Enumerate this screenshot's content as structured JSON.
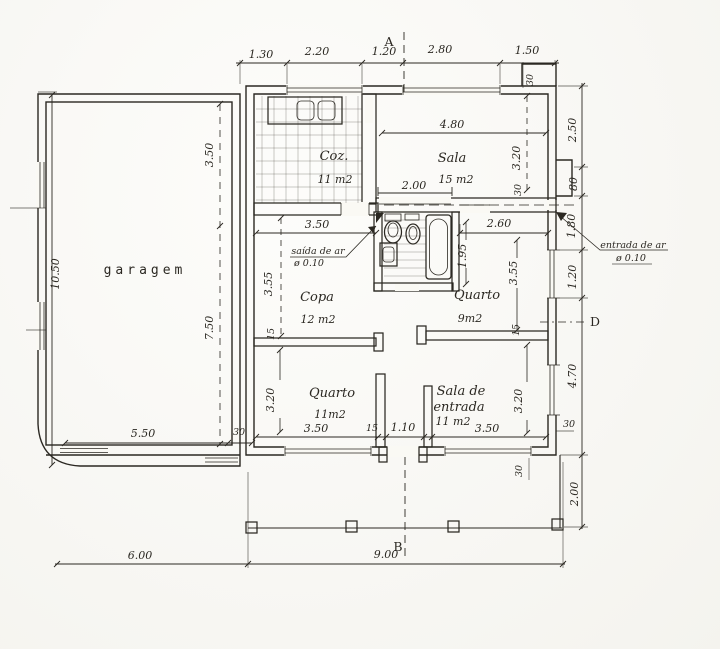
{
  "drawing": {
    "type": "residential floor plan",
    "ink": "#2b2822",
    "paper": "#faf9f4"
  },
  "rooms": {
    "garagem": {
      "label": "garagem"
    },
    "cozinha": {
      "label": "Coz.",
      "area": "11 m2"
    },
    "sala": {
      "label": "Sala",
      "area": "15 m2"
    },
    "copa": {
      "label": "Copa",
      "area": "12 m2"
    },
    "quarto9": {
      "label": "Quarto",
      "area": "9m2"
    },
    "quarto11": {
      "label": "Quarto",
      "area": "11m2"
    },
    "sala_entrada": {
      "label1": "Sala de",
      "label2": "entrada",
      "area": "11 m2"
    }
  },
  "markers": {
    "a": "A",
    "b": "B",
    "d": "D"
  },
  "notes": {
    "saida_ar": {
      "line1": "saída de ar",
      "line2": "ø 0.10"
    },
    "entrada_ar": {
      "line1": "entrada de ar",
      "line2": "ø 0.10"
    }
  },
  "dims": {
    "top": {
      "d1": "1.30",
      "d2": "2.20",
      "d3": "1.20",
      "d4": "2.80",
      "d5": "1.50",
      "wall": "30"
    },
    "right": {
      "d1": "2.50",
      "d2": "80",
      "d3": "1.80",
      "d4": "1.20",
      "d5": "4.70",
      "wall": "30",
      "porch": "2.00"
    },
    "bottom": {
      "garage": "6.00",
      "house": "9.00",
      "porch_wall": "30"
    },
    "garage": {
      "height": "10.50",
      "upper": "3.50",
      "lower": "7.50",
      "width": "5.50",
      "wall": "30"
    },
    "sala": {
      "width": "4.80",
      "opening": "2.00",
      "height": "3.20",
      "wall": "30"
    },
    "copa": {
      "width": "3.50",
      "height": "3.55",
      "wall": "15"
    },
    "bathroom": {
      "depth": "1.95"
    },
    "quarto9": {
      "width": "2.60",
      "height": "3.55",
      "wall": "15"
    },
    "quarto11": {
      "height": "3.20",
      "width": "3.50",
      "wall": "15",
      "door": "1.10"
    },
    "sala_entrada": {
      "width": "3.50",
      "height": "3.20"
    }
  }
}
